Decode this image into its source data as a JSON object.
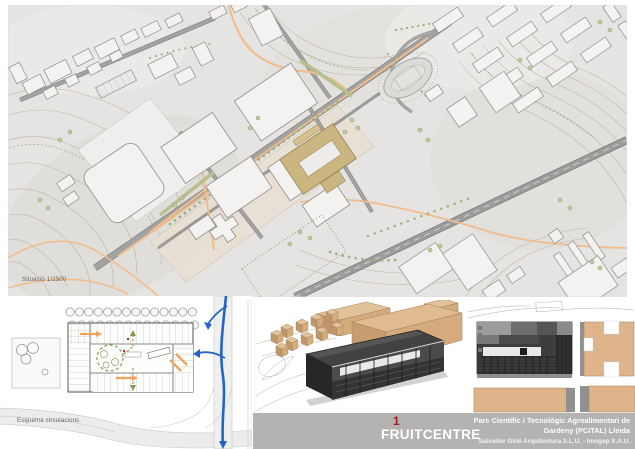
{
  "title_block": {
    "sheet_number": "1",
    "project_name": "FRUITCENTRE",
    "park_name_line1": "Parc Científic i Tecnològic Agroalimentari de",
    "park_name_line2": "Gardeny (PCiTAL) Lleida",
    "credits": "Salvador Giné Arquitectura S.L.U. - Imogep S.A.U.",
    "colors": {
      "bar_background": "#b4b3b1",
      "sheet_number": "#9e1b1e",
      "text": "#ffffff"
    }
  },
  "site_plan": {
    "caption": "Situació 1/2500",
    "colors": {
      "terrain": "#e5e4e2",
      "roads": "#8b8b8b",
      "pedestrian_paths": "#f2bd8d",
      "highlighted_building": "#cbb581",
      "vegetation": "#9fae7d"
    }
  },
  "circulation_diagram": {
    "caption": "Esquema circulacions",
    "colors": {
      "vehicle_route": "#2563c9",
      "pedestrian_loop": "#7f9c52",
      "access_arrows": "#f0a35e"
    }
  }
}
